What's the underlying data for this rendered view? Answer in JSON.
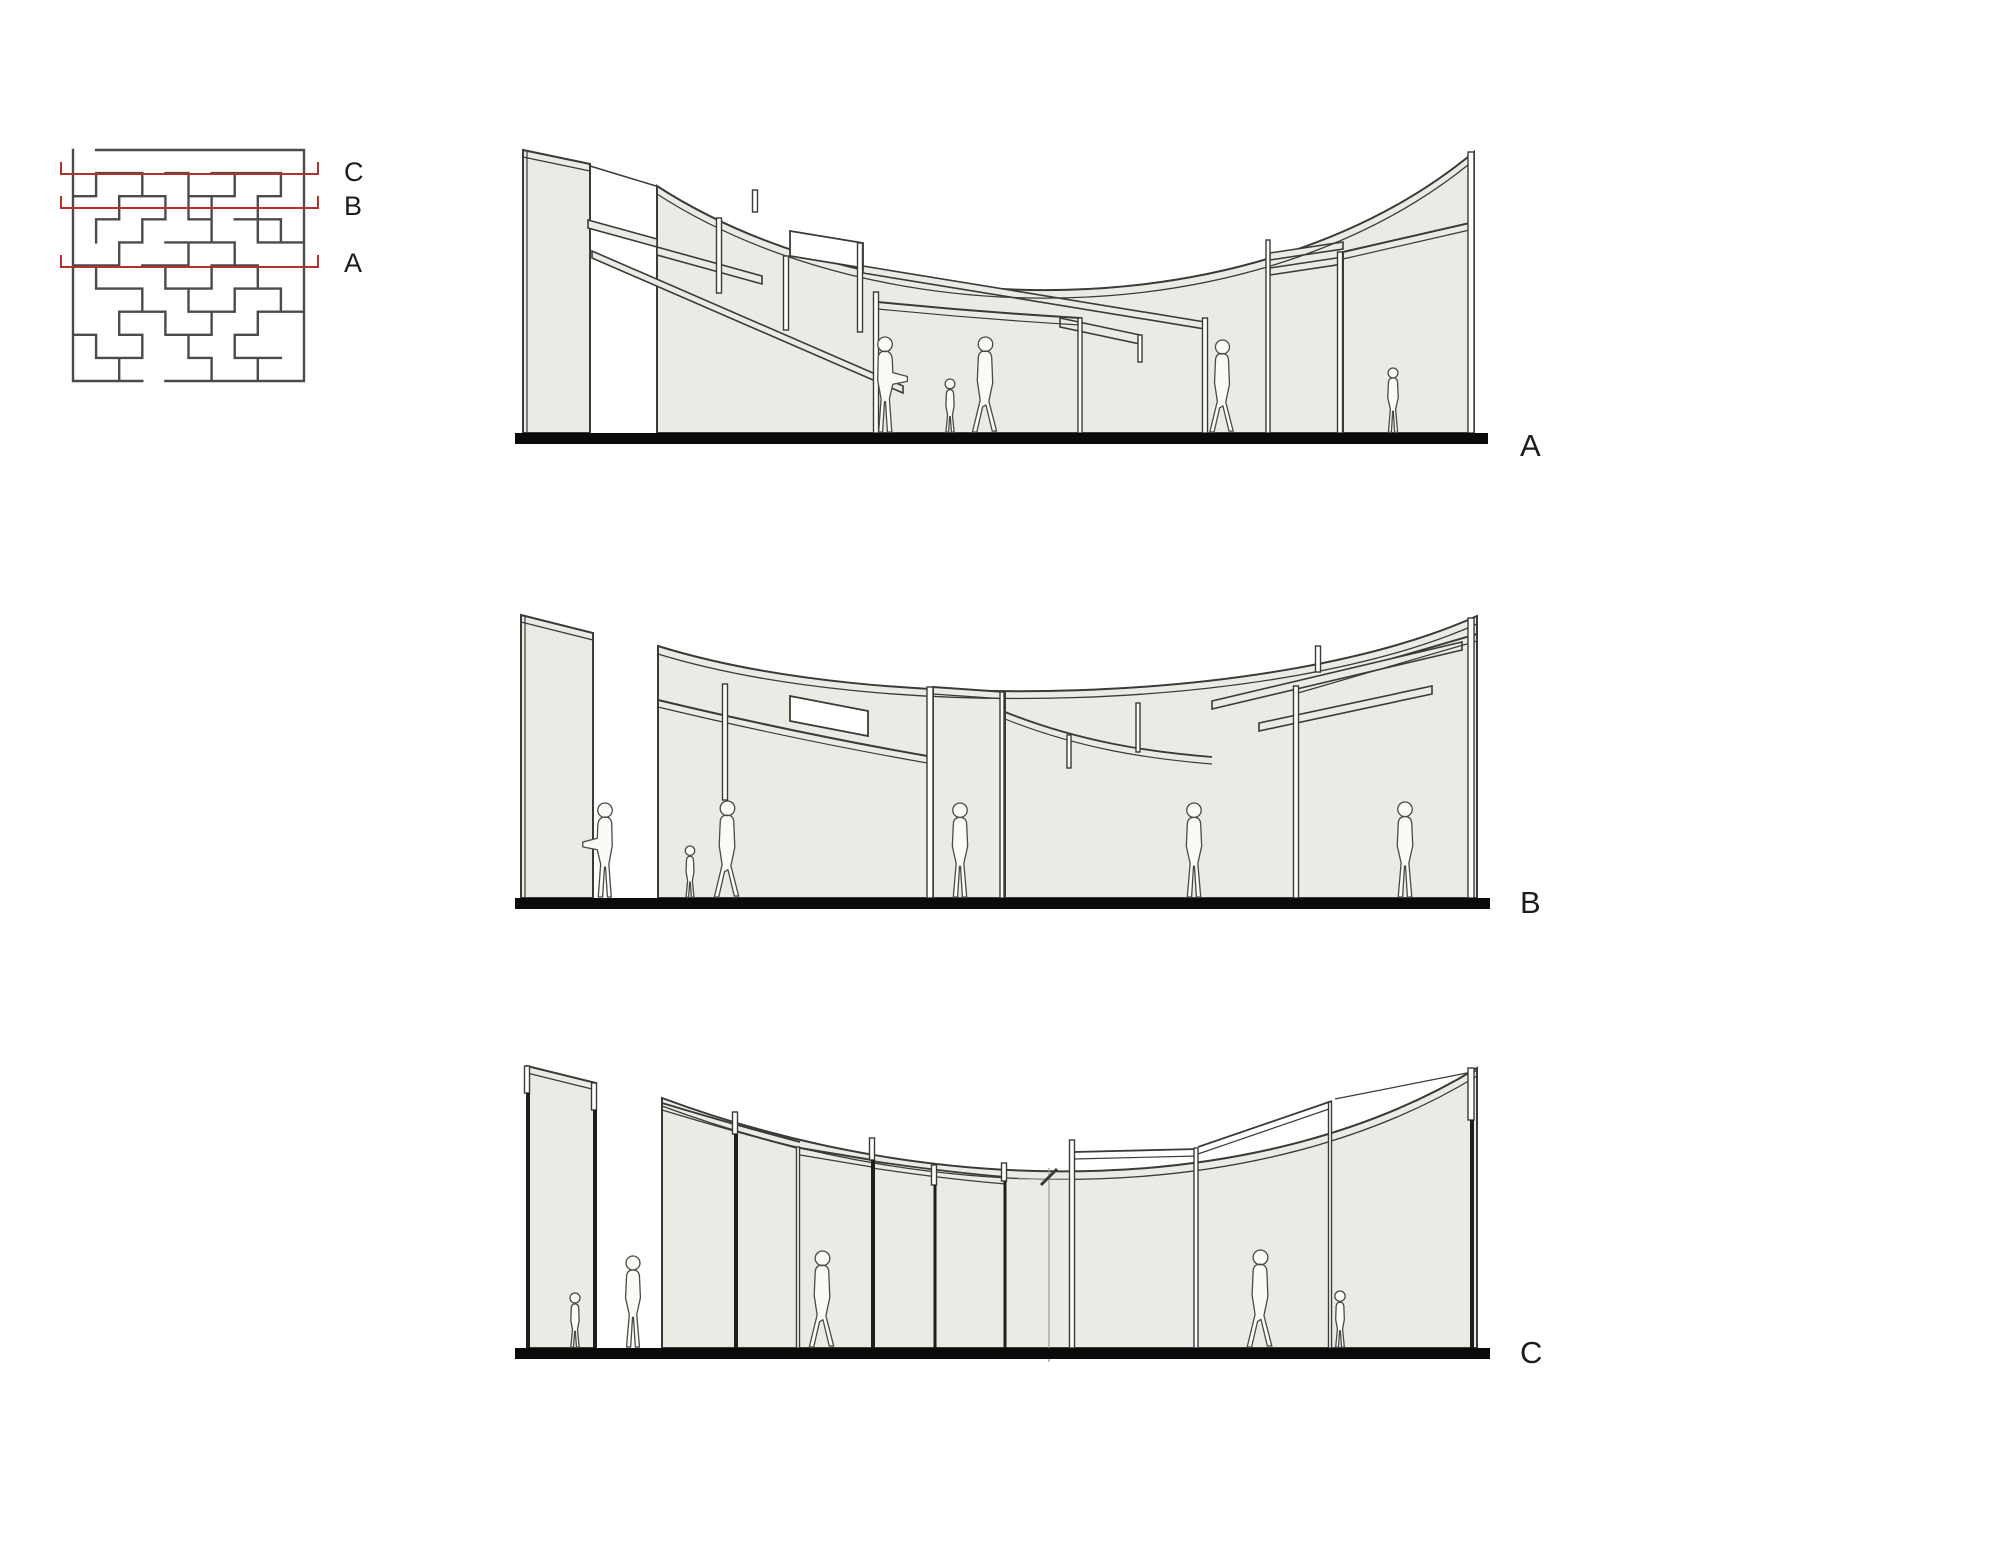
{
  "drawing_title": "Maze pavilion — plan with section cut lines and sections A, B, C",
  "colors": {
    "background": "#ffffff",
    "wall_fill": "#eceae5",
    "line": "#3a3a37",
    "thin_line": "#6f6f6a",
    "dark": "#1d1d1b",
    "ground": "#0a0a0a",
    "maze_wall": "#4b4b49",
    "cut_red": "#b5302d",
    "figure_fill": "#fbfaf6",
    "figure_line": "#4a4a46",
    "marker_gray": "#9a9a96"
  },
  "plan": {
    "x": 73,
    "y": 150,
    "cell": 23.1,
    "cols": 10,
    "rows": 10,
    "line_x1": 61,
    "line_x2": 318,
    "tick_h": 12,
    "label_x": 344,
    "cut_lines": [
      {
        "label": "C",
        "y": 174,
        "label_y": 181
      },
      {
        "label": "B",
        "y": 208,
        "label_y": 215
      },
      {
        "label": "A",
        "y": 267,
        "label_y": 272
      }
    ],
    "walls": [
      [
        1,
        0,
        10,
        0
      ],
      [
        0,
        10,
        3,
        10
      ],
      [
        4,
        10,
        10,
        10
      ],
      [
        1,
        1,
        3,
        1
      ],
      [
        4,
        1,
        5,
        1
      ],
      [
        6,
        1,
        9,
        1
      ],
      [
        0,
        2,
        1,
        2
      ],
      [
        2,
        2,
        4,
        2
      ],
      [
        5,
        2,
        7,
        2
      ],
      [
        8,
        2,
        9,
        2
      ],
      [
        1,
        3,
        2,
        3
      ],
      [
        3,
        3,
        4,
        3
      ],
      [
        5,
        3,
        6,
        3
      ],
      [
        7,
        3,
        9,
        3
      ],
      [
        2,
        4,
        3,
        4
      ],
      [
        4,
        4,
        7,
        4
      ],
      [
        8,
        4,
        10,
        4
      ],
      [
        0,
        5,
        2,
        5
      ],
      [
        3,
        5,
        5,
        5
      ],
      [
        6,
        5,
        8,
        5
      ],
      [
        1,
        6,
        3,
        6
      ],
      [
        4,
        6,
        6,
        6
      ],
      [
        7,
        6,
        9,
        6
      ],
      [
        2,
        7,
        4,
        7
      ],
      [
        5,
        7,
        7,
        7
      ],
      [
        8,
        7,
        10,
        7
      ],
      [
        0,
        8,
        1,
        8
      ],
      [
        2,
        8,
        3,
        8
      ],
      [
        4,
        8,
        6,
        8
      ],
      [
        7,
        8,
        8,
        8
      ],
      [
        1,
        9,
        3,
        9
      ],
      [
        5,
        9,
        6,
        9
      ],
      [
        7,
        9,
        9,
        9
      ],
      [
        0,
        0,
        0,
        10
      ],
      [
        10,
        0,
        10,
        10
      ],
      [
        1,
        1,
        1,
        2
      ],
      [
        3,
        1,
        3,
        2
      ],
      [
        5,
        1,
        5,
        3
      ],
      [
        7,
        1,
        7,
        2
      ],
      [
        9,
        1,
        9,
        2
      ],
      [
        2,
        2,
        2,
        3
      ],
      [
        4,
        2,
        4,
        3
      ],
      [
        6,
        2,
        6,
        3
      ],
      [
        8,
        2,
        8,
        4
      ],
      [
        1,
        3,
        1,
        4
      ],
      [
        3,
        3,
        3,
        4
      ],
      [
        6,
        3,
        6,
        4
      ],
      [
        9,
        3,
        9,
        4
      ],
      [
        2,
        4,
        2,
        5
      ],
      [
        5,
        4,
        5,
        5
      ],
      [
        7,
        4,
        7,
        5
      ],
      [
        1,
        5,
        1,
        6
      ],
      [
        4,
        5,
        4,
        6
      ],
      [
        6,
        5,
        6,
        6
      ],
      [
        8,
        5,
        8,
        6
      ],
      [
        3,
        6,
        3,
        7
      ],
      [
        5,
        6,
        5,
        7
      ],
      [
        7,
        6,
        7,
        7
      ],
      [
        9,
        6,
        9,
        7
      ],
      [
        2,
        7,
        2,
        8
      ],
      [
        4,
        7,
        4,
        8
      ],
      [
        6,
        7,
        6,
        8
      ],
      [
        8,
        7,
        8,
        8
      ],
      [
        1,
        8,
        1,
        9
      ],
      [
        3,
        8,
        3,
        9
      ],
      [
        5,
        8,
        5,
        9
      ],
      [
        7,
        8,
        7,
        9
      ],
      [
        2,
        9,
        2,
        10
      ],
      [
        6,
        9,
        6,
        10
      ],
      [
        8,
        9,
        8,
        10
      ]
    ]
  },
  "figure_variants": {
    "stand": {
      "d": "M -7 -1 L -4 -36 L -8 -54 L -7 -76 Q -7 -84 0 -84 Q 7 -84 7 -76 L 8 -54 L 4 -36 L 7 -1 L 2.5 -1 L 0.5 -33 L -0.5 -33 L -2.5 -1 Z M -7.5 -91.5 a 7.5 7.5 0 1 0 15 0 a 7.5 7.5 0 1 0 -15 0 Z",
      "unit": 99
    },
    "walk": {
      "d": "M -13 -1 L -5 -34 L -8 -54 L -7 -77 Q -7 -85 0 -85 Q 7 -85 7 -77 L 8 -52 L 4 -33 L 12 -2 L 7.5 -2 L 1 -29 L -2.5 -27 L -8.5 -1 Z M -7 -92 a 7.5 7.5 0 1 0 15 0 a 7.5 7.5 0 1 0 -15 0 Z",
      "unit": 99.5
    },
    "point": {
      "d": "M -6.5 -1 L -4 -35 L -7.5 -54 L -7 -76 Q -7 -84 0 -84 Q 7 -84 7.5 -75 L 8 -62 L 23 -58 L 23 -53 L 8 -50 L 4.5 -35 L 7 -1 L 2.5 -1 L 0.5 -32 L -0.5 -32 L -2.5 -1 Z M -7.5 -91 a 7.5 7.5 0 1 0 15 0 a 7.5 7.5 0 1 0 -15 0 Z",
      "unit": 98.5
    },
    "child": {
      "d": "M -5 -1 L -3 -22 L -5 -33 L -4.5 -47 Q -4.5 -53 0 -53 Q 4.5 -53 4.5 -47 L 5 -33 L 3 -22 L 5 -1 L 1.8 -1 L 0.4 -20 L -0.4 -20 L -1.8 -1 Z M -6 -60 a 6 6 0 1 0 12 0 a 6 6 0 1 0 -12 0 Z",
      "unit": 66
    }
  },
  "sections": [
    {
      "id": "A",
      "label": "A",
      "label_x": 1520,
      "label_y": 456,
      "ground": {
        "x1": 515,
        "x2": 1488,
        "y": 433,
        "h": 11
      },
      "panels": [
        {
          "d": "M657,186 C880,330 1260,330 1474,152 L1474,433 L657,433 Z"
        },
        {
          "d": "M523,150 L590,164 L590,433 L523,433 Z"
        },
        {
          "d": "M878,302 Q979,312 1080,318 L1080,433 L878,433 Z"
        },
        {
          "d": "M1343,252 L1474,222 L1474,433 L1343,433 Z"
        }
      ],
      "strips": [
        {
          "d": "M588,220 L657,239 L657,247 L588,228 Z"
        },
        {
          "d": "M657,247 L762,276 L762,284 L657,255 Z"
        },
        {
          "d": "M592,251 L903,386 L903,393 L592,258 Z"
        },
        {
          "d": "M863,266 L1205,322 L1205,329 L863,273 Z"
        },
        {
          "d": "M1060,318 L1140,335 L1140,344 L1060,327 Z"
        },
        {
          "d": "M1270,253 L1343,242 L1343,249 L1270,260 Z"
        },
        {
          "d": "M1270,268 L1343,257 L1343,264 L1270,275 Z"
        }
      ],
      "whites": [
        {
          "d": "M790,231 L863,243 L863,268 L790,256 Z"
        }
      ],
      "lines": [
        {
          "d": "M590,166 L656,186",
          "w": 1.5
        },
        {
          "d": "M657,194 C880,338 1260,338 1474,160",
          "w": 1.3
        },
        {
          "d": "M523,157 L590,171",
          "w": 1.3
        },
        {
          "d": "M527,152 L527,433",
          "w": 1.2
        },
        {
          "d": "M878,309 Q979,319 1080,325",
          "w": 1.2
        },
        {
          "d": "M1343,259 L1474,229",
          "w": 1.2
        }
      ],
      "posts": [
        {
          "x": 719,
          "y1": 218,
          "y2": 293,
          "w": 5,
          "style": "open"
        },
        {
          "x": 755,
          "y1": 190,
          "y2": 212,
          "w": 5,
          "style": "open"
        },
        {
          "x": 786,
          "y1": 256,
          "y2": 330,
          "w": 5,
          "style": "open"
        },
        {
          "x": 860,
          "y1": 243,
          "y2": 332,
          "w": 5,
          "style": "open"
        },
        {
          "x": 876,
          "y1": 292,
          "y2": 433,
          "w": 5,
          "style": "open"
        },
        {
          "x": 1080,
          "y1": 318,
          "y2": 433,
          "w": 4,
          "style": "open"
        },
        {
          "x": 1140,
          "y1": 335,
          "y2": 362,
          "w": 4,
          "style": "open"
        },
        {
          "x": 1205,
          "y1": 318,
          "y2": 433,
          "w": 5,
          "style": "open"
        },
        {
          "x": 1268,
          "y1": 240,
          "y2": 433,
          "w": 4,
          "style": "open"
        },
        {
          "x": 1340,
          "y1": 252,
          "y2": 433,
          "w": 5,
          "style": "open"
        },
        {
          "x": 1471,
          "y1": 152,
          "y2": 433,
          "w": 6,
          "style": "open"
        }
      ],
      "figures": [
        {
          "v": "point",
          "x": 885,
          "y": 433,
          "h": 96,
          "flip": false
        },
        {
          "v": "child",
          "x": 950,
          "y": 433,
          "h": 54,
          "flip": false
        },
        {
          "v": "walk",
          "x": 985,
          "y": 433,
          "h": 96,
          "flip": false
        },
        {
          "v": "walk",
          "x": 1222,
          "y": 433,
          "h": 93,
          "flip": false
        },
        {
          "v": "stand",
          "x": 1393,
          "y": 433,
          "h": 65,
          "flip": false
        }
      ]
    },
    {
      "id": "B",
      "label": "B",
      "label_x": 1520,
      "label_y": 913,
      "ground": {
        "x1": 515,
        "x2": 1490,
        "y": 898,
        "h": 11
      },
      "panels": [
        {
          "d": "M521,615 L593,633 L593,898 L521,898 Z"
        },
        {
          "d": "M658,646 C880,715 1280,705 1477,616 L1477,898 L658,898 Z"
        },
        {
          "d": "M658,700 Q800,734 933,757 L933,898 L658,898 Z"
        },
        {
          "d": "M933,687 L1005,692 L1005,898 L933,898 Z"
        },
        {
          "d": "M1298,686 L1477,634 L1477,898 L1298,898 Z"
        }
      ],
      "strips": [
        {
          "d": "M1212,701 L1462,642 L1462,650 L1212,709 Z"
        },
        {
          "d": "M1259,723 L1432,686 L1432,694 L1259,731 Z"
        }
      ],
      "whites": [
        {
          "d": "M790,696 L868,711 L868,736 L790,721 Z"
        }
      ],
      "lines": [
        {
          "d": "M521,622 L593,640",
          "w": 1.3
        },
        {
          "d": "M525,617 L525,898",
          "w": 1.2
        },
        {
          "d": "M658,654 C880,722 1280,712 1477,624",
          "w": 1.3
        },
        {
          "d": "M658,707 Q800,741 933,764",
          "w": 1.2
        },
        {
          "d": "M933,694 L1005,699",
          "w": 1.2
        },
        {
          "d": "M1298,693 L1477,641",
          "w": 1.2
        },
        {
          "d": "M1005,712 C1080,742 1150,752 1212,757",
          "w": 1.8
        },
        {
          "d": "M1005,719 C1080,749 1150,759 1212,764",
          "w": 1.2
        }
      ],
      "posts": [
        {
          "x": 725,
          "y1": 684,
          "y2": 800,
          "w": 5,
          "style": "open"
        },
        {
          "x": 930,
          "y1": 687,
          "y2": 898,
          "w": 6,
          "style": "open"
        },
        {
          "x": 1002,
          "y1": 692,
          "y2": 898,
          "w": 4,
          "style": "open"
        },
        {
          "x": 1069,
          "y1": 735,
          "y2": 768,
          "w": 4,
          "style": "open"
        },
        {
          "x": 1138,
          "y1": 703,
          "y2": 752,
          "w": 4,
          "style": "open"
        },
        {
          "x": 1318,
          "y1": 646,
          "y2": 672,
          "w": 5,
          "style": "open"
        },
        {
          "x": 1296,
          "y1": 686,
          "y2": 898,
          "w": 5,
          "style": "open"
        },
        {
          "x": 1471,
          "y1": 618,
          "y2": 898,
          "w": 6,
          "style": "open"
        }
      ],
      "figures": [
        {
          "v": "point",
          "x": 605,
          "y": 898,
          "h": 95,
          "flip": true
        },
        {
          "v": "child",
          "x": 690,
          "y": 898,
          "h": 52,
          "flip": false
        },
        {
          "v": "walk",
          "x": 727,
          "y": 898,
          "h": 97,
          "flip": false
        },
        {
          "v": "stand",
          "x": 960,
          "y": 898,
          "h": 95,
          "flip": false
        },
        {
          "v": "stand",
          "x": 1194,
          "y": 898,
          "h": 95,
          "flip": false
        },
        {
          "v": "stand",
          "x": 1405,
          "y": 898,
          "h": 96,
          "flip": false
        }
      ]
    },
    {
      "id": "C",
      "label": "C",
      "label_x": 1520,
      "label_y": 1363,
      "ground": {
        "x1": 515,
        "x2": 1490,
        "y": 1348,
        "h": 11
      },
      "panels": [
        {
          "d": "M527,1066 L596,1083 L596,1348 L527,1348 Z"
        },
        {
          "d": "M662,1098 C950,1205 1270,1195 1477,1068 L1477,1348 L662,1348 Z"
        }
      ],
      "strips": [],
      "whites": [],
      "lines": [
        {
          "d": "M527,1073 L596,1090",
          "w": 1.3
        },
        {
          "d": "M662,1106 C950,1213 1270,1203 1477,1076",
          "w": 1.3
        },
        {
          "d": "M662,1103 Q735,1125 800,1142",
          "w": 1.8
        },
        {
          "d": "M662,1110 Q735,1132 800,1149",
          "w": 1.2
        },
        {
          "d": "M800,1148 L872,1160",
          "w": 2
        },
        {
          "d": "M800,1155 L872,1167",
          "w": 1.2
        },
        {
          "d": "M872,1161 Q945,1172 1006,1177",
          "w": 1.8
        },
        {
          "d": "M872,1168 Q945,1179 1006,1184",
          "w": 1.2
        },
        {
          "d": "M1074,1152 L1198,1149",
          "w": 1.8
        },
        {
          "d": "M1074,1159 L1198,1156",
          "w": 1.2
        },
        {
          "d": "M1198,1147 L1332,1101",
          "w": 1.8
        },
        {
          "d": "M1198,1154 L1332,1108",
          "w": 1.2
        },
        {
          "d": "M1335,1099 L1477,1071",
          "w": 1.2
        },
        {
          "d": "M1018,1179 L1072,1179",
          "w": 1.2,
          "c": "gray"
        },
        {
          "d": "M1049,1168 L1049,1362",
          "w": 1.2,
          "c": "gray"
        },
        {
          "d": "M1041,1185 L1057,1169",
          "w": 3
        }
      ],
      "posts": [
        {
          "x": 527,
          "y1": 1066,
          "y2": 1093,
          "w": 5,
          "style": "open"
        },
        {
          "x": 528,
          "y1": 1093,
          "y2": 1348,
          "w": 4,
          "style": "solid"
        },
        {
          "x": 594,
          "y1": 1083,
          "y2": 1110,
          "w": 5,
          "style": "open"
        },
        {
          "x": 595,
          "y1": 1110,
          "y2": 1348,
          "w": 4,
          "style": "solid"
        },
        {
          "x": 735,
          "y1": 1112,
          "y2": 1134,
          "w": 5,
          "style": "open"
        },
        {
          "x": 736,
          "y1": 1134,
          "y2": 1348,
          "w": 4,
          "style": "solid"
        },
        {
          "x": 798,
          "y1": 1147,
          "y2": 1348,
          "w": 3,
          "style": "open"
        },
        {
          "x": 872,
          "y1": 1138,
          "y2": 1160,
          "w": 5,
          "style": "open"
        },
        {
          "x": 873,
          "y1": 1160,
          "y2": 1348,
          "w": 4,
          "style": "solid"
        },
        {
          "x": 934,
          "y1": 1165,
          "y2": 1185,
          "w": 5,
          "style": "open"
        },
        {
          "x": 935,
          "y1": 1185,
          "y2": 1348,
          "w": 3,
          "style": "solid"
        },
        {
          "x": 1004,
          "y1": 1163,
          "y2": 1181,
          "w": 5,
          "style": "open"
        },
        {
          "x": 1005,
          "y1": 1181,
          "y2": 1348,
          "w": 3,
          "style": "solid"
        },
        {
          "x": 1072,
          "y1": 1140,
          "y2": 1348,
          "w": 5,
          "style": "open"
        },
        {
          "x": 1196,
          "y1": 1148,
          "y2": 1348,
          "w": 4,
          "style": "open"
        },
        {
          "x": 1330,
          "y1": 1102,
          "y2": 1348,
          "w": 3,
          "style": "open"
        },
        {
          "x": 1471,
          "y1": 1068,
          "y2": 1120,
          "w": 6,
          "style": "open"
        },
        {
          "x": 1472,
          "y1": 1120,
          "y2": 1348,
          "w": 4,
          "style": "solid"
        }
      ],
      "figures": [
        {
          "v": "child",
          "x": 575,
          "y": 1348,
          "h": 55,
          "flip": false
        },
        {
          "v": "stand",
          "x": 633,
          "y": 1348,
          "h": 92,
          "flip": false
        },
        {
          "v": "walk",
          "x": 822,
          "y": 1348,
          "h": 97,
          "flip": false
        },
        {
          "v": "walk",
          "x": 1260,
          "y": 1348,
          "h": 98,
          "flip": false
        },
        {
          "v": "child",
          "x": 1340,
          "y": 1348,
          "h": 57,
          "flip": false
        }
      ]
    }
  ]
}
